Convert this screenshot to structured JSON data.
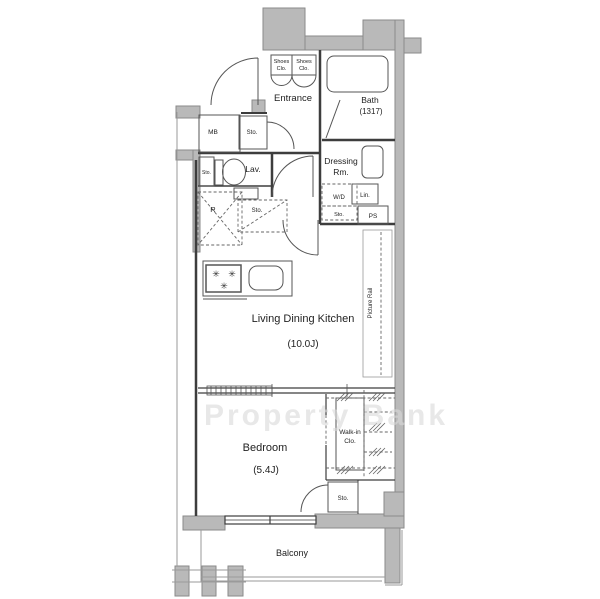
{
  "plan": {
    "rooms": {
      "entrance": "Entrance",
      "bath": "Bath",
      "bath_size": "(1317)",
      "dressing_line1": "Dressing",
      "dressing_line2": "Rm.",
      "lav": "Lav.",
      "ldk": "Living Dining Kitchen",
      "ldk_size": "(10.0J)",
      "bedroom": "Bedroom",
      "bedroom_size": "(5.4J)",
      "wic_line1": "Walk-in",
      "wic_line2": "Clo.",
      "balcony": "Balcony"
    },
    "small_labels": {
      "shoes": "Shoes",
      "clo": "Clo.",
      "mb": "MB",
      "sto": "Sto.",
      "wd": "W/D",
      "lin": "Lin.",
      "ps": "PS",
      "fridge": "R",
      "picture_rail": "Picture Rail"
    },
    "icons": {
      "burner_glyph": "✳"
    },
    "watermark": "Property Bank",
    "colors": {
      "wall": "#b9b9b9",
      "wall_stroke": "#8a8a8a",
      "line": "#3d3d3d",
      "fixture": "#555555",
      "dash": "#666666",
      "light": "#999999",
      "text": "#222222",
      "watermark": "#d9d9d9"
    }
  }
}
